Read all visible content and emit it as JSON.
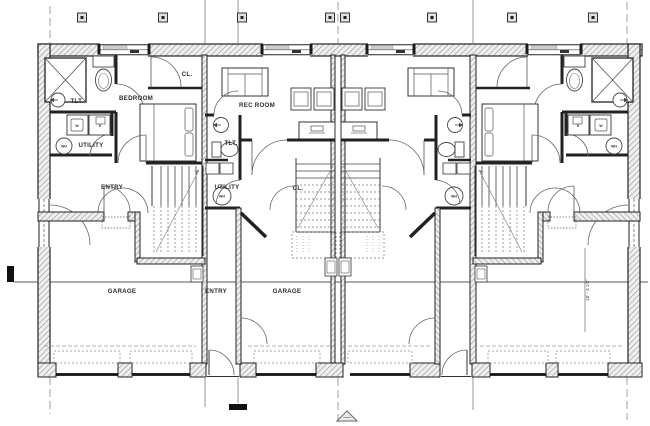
{
  "drawing_title": "four-unit townhouse first floor plan",
  "rooms": {
    "bedroom": "BEDROOM",
    "rec_room": "REC ROOM",
    "toilet": "TLT.",
    "closet": "CL.",
    "utility": "UTILITY",
    "entry": "ENTRY",
    "garage": "GARAGE"
  },
  "appliances": {
    "washer": "W",
    "dryer": "D",
    "water_heater": "WH"
  },
  "dimensions": {
    "garage_depth": "18' - 4 1/2\""
  },
  "colors": {
    "background": "#ffffff",
    "wall_line": "#1f1f1f",
    "thin_line": "#4a4a4a",
    "hatch": "#8f8f8f",
    "grid_line": "#8a8a8a",
    "text": "#2e2e2e"
  }
}
